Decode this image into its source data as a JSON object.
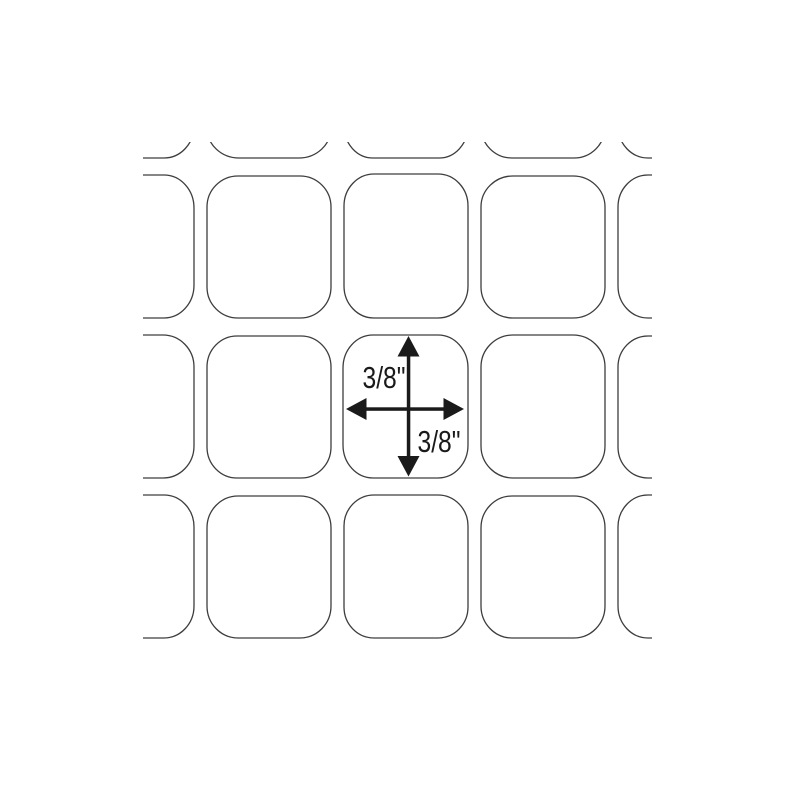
{
  "diagram": {
    "labels": {
      "top": "3/8\"",
      "bottom": "3/8\""
    },
    "colors": {
      "background": "#ffffff",
      "grid_line": "#3d3d3d",
      "arrow": "#1a1a1a",
      "label_text": "#1a1a1a"
    }
  }
}
